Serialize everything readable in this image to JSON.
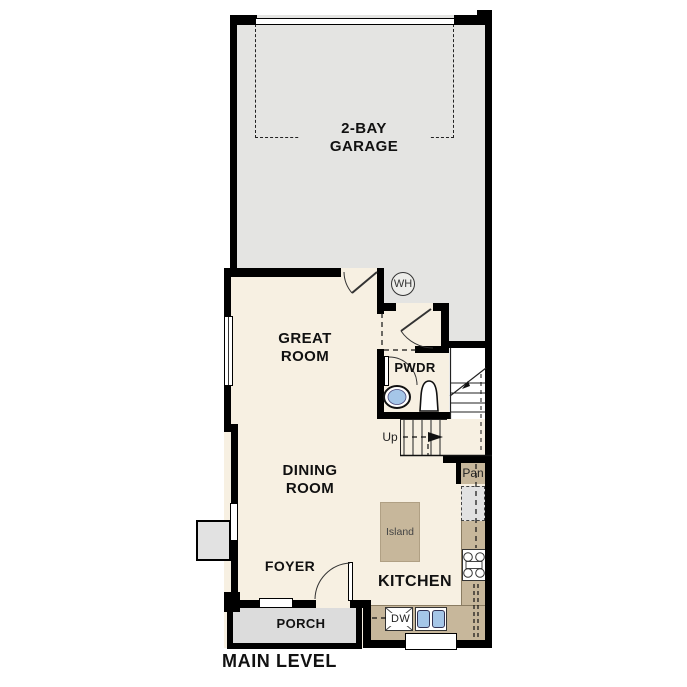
{
  "plan": {
    "caption": "MAIN LEVEL",
    "rooms": {
      "garage": "2-BAY\nGARAGE",
      "great_room": "GREAT\nROOM",
      "dining_room": "DINING\nROOM",
      "foyer": "FOYER",
      "kitchen": "KITCHEN",
      "porch": "PORCH",
      "powder": "PWDR"
    },
    "fixtures": {
      "island": "Island",
      "pantry": "Pan",
      "dishwasher": "DW",
      "water_heater": "WH",
      "stairs_direction": "Up"
    }
  },
  "colors": {
    "wall": "#000000",
    "garage": "#e4e4e2",
    "interior": "#f7f0e2",
    "counter": "#c7b79b",
    "porch": "#dcdcdc",
    "appliance": "#e2e2e2",
    "sink": "#a5c6e8",
    "text": "#111111"
  }
}
